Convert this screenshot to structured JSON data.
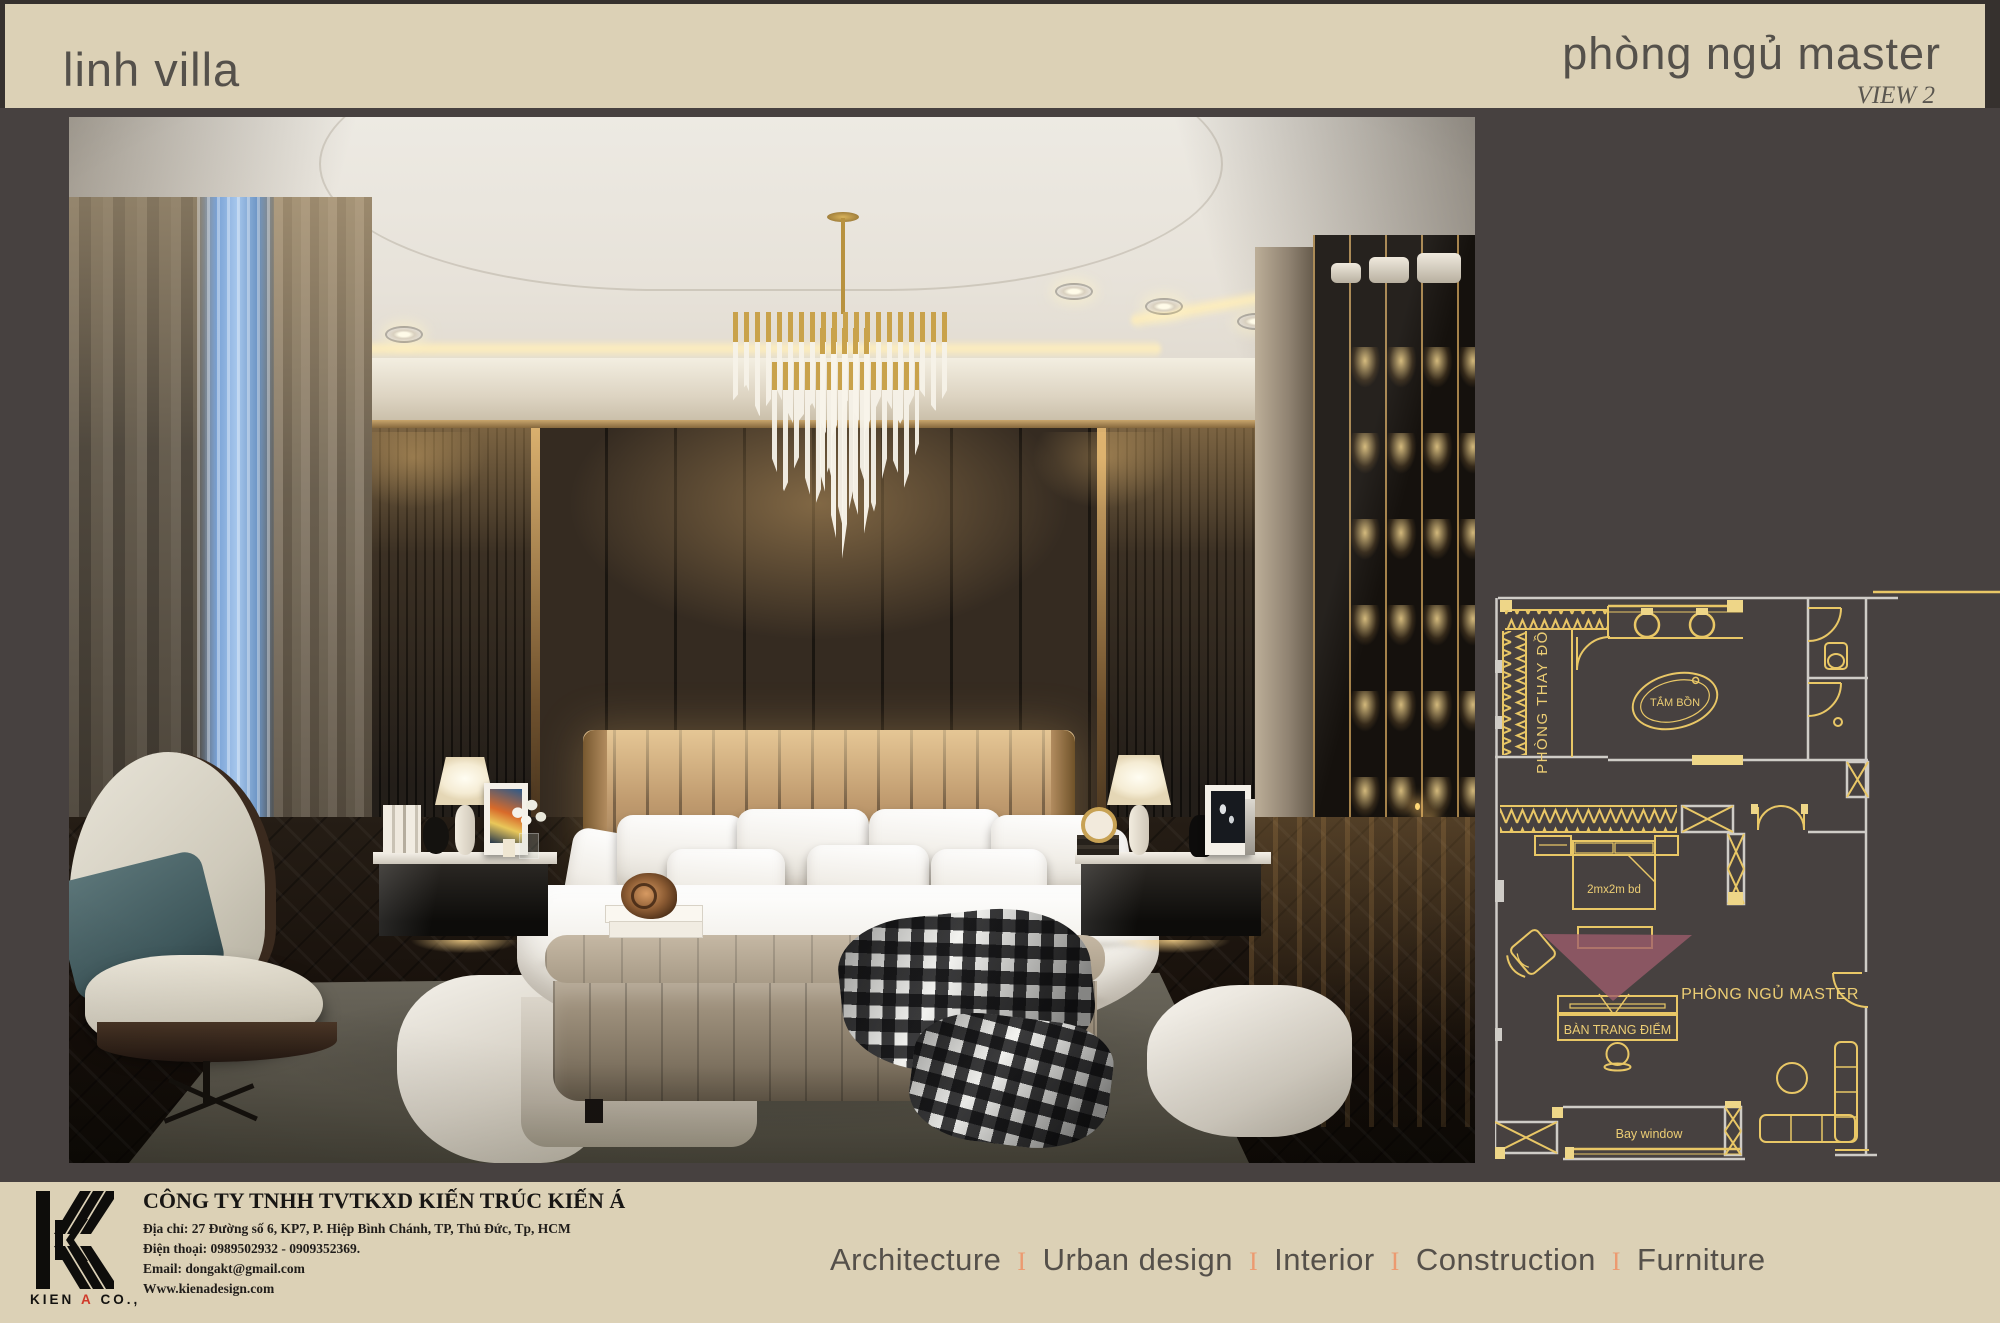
{
  "header": {
    "project_title": "linh villa",
    "room_title": "phòng ngủ master",
    "view_label": "VIEW 2"
  },
  "floor_plan": {
    "labels": {
      "dressing_room": "PHÒNG THAY ĐỒ",
      "bathtub": "TẮM BỒN",
      "bed": "2mx2m bd",
      "dressing_table": "BÀN TRANG ĐIỂM",
      "master_bedroom": "PHÒNG NGỦ MASTER",
      "bay_window": "Bay window"
    },
    "colors": {
      "line_gold": "#e9c766",
      "line_white": "#cfccc7",
      "view_cone": "#9d5c6c",
      "background": "#474140"
    }
  },
  "footer": {
    "logo": {
      "text_1": "KIEN",
      "text_accent": "A",
      "text_2": "CO.,"
    },
    "company_name": "CÔNG TY TNHH TVTKXD KIẾN TRÚC KIẾN Á",
    "address": "Địa chỉ: 27 Đường số 6, KP7, P. Hiệp Bình Chánh, TP, Thủ Đức, Tp, HCM",
    "phone": "Điện thoại: 0989502932 - 0909352369.",
    "email": "Email: dongakt@gmail.com",
    "website": "Www.kienadesign.com",
    "services": [
      "Architecture",
      "Urban design",
      "Interior",
      "Construction",
      "Furniture"
    ],
    "services_separator": "I",
    "accent_colors": {
      "brand_red": "#d0392a",
      "separator_orange": "#ec9a70",
      "band_beige": "#dcd1b6"
    }
  }
}
